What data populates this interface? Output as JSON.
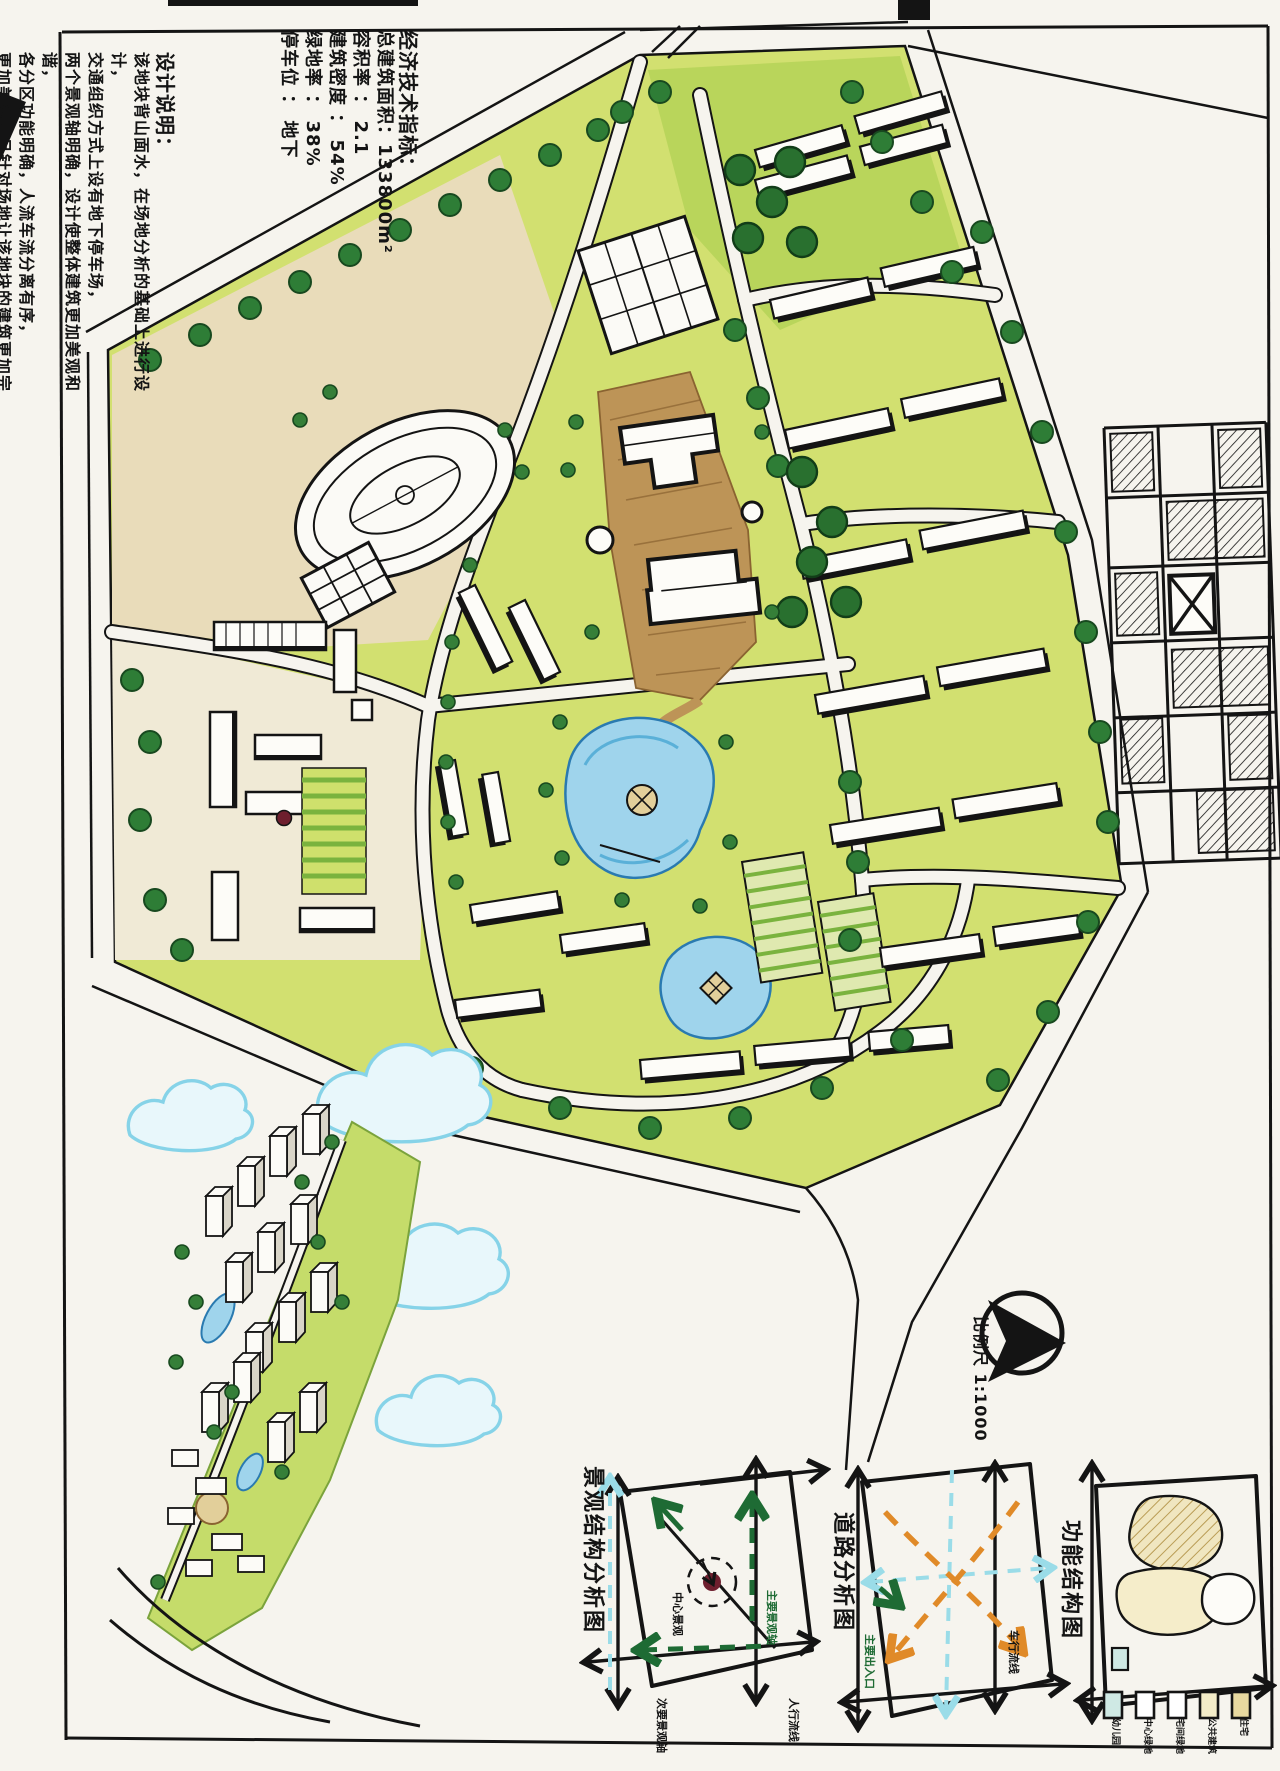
{
  "indicators": {
    "title": "经济技术指标：",
    "items": [
      "总建筑面积：133800m²",
      "容积率 ： 2.1",
      "建筑密度 ： 54%",
      "绿地率 ： 38%",
      "停车位 ： 地下"
    ]
  },
  "design_notes": {
    "title": "设计说明：",
    "lines": [
      "该地块背山面水，在场地分析的基础上进行设计，",
      "交通组织方式上设有地下停车场，",
      "两个景观轴明确，设计使整体建筑更加美观和谐，",
      "各分区功能明确，人流车流分离有序，",
      "更加美观，且针对场地让该地块的建筑更加完美。"
    ]
  },
  "north_arrow": {
    "scale_label": "比例尺 1:1000"
  },
  "analysis_diagrams": [
    {
      "title": "景观结构分析图",
      "annotations": [
        "中心景观",
        "主要景观轴",
        "次要景观轴"
      ]
    },
    {
      "title": "道路分析图",
      "annotations": [
        "主要出入口",
        "车行流线",
        "人行流线"
      ]
    },
    {
      "title": "功能结构图",
      "legend": [
        {
          "label": "幼儿园",
          "color": "#cfe9e4"
        },
        {
          "label": "中心绿地",
          "color": "#ffffff"
        },
        {
          "label": "宅间绿地",
          "color": "#ffffff"
        },
        {
          "label": "公共建筑",
          "color": "#f3ecc8"
        },
        {
          "label": "住宅",
          "color": "#e8d9a0"
        }
      ]
    }
  ],
  "colors": {
    "paper": "#f6f4ee",
    "linework": "#141414",
    "lawn": "#d2e070",
    "tree": "#2e7d36",
    "water": "#9fd4ec",
    "plaza": "#bd9457",
    "accent_red": "#6e1f2e",
    "diagram_green": "#1e6b34",
    "diagram_orange": "#e08a28",
    "diagram_cyan": "#9adce8"
  }
}
